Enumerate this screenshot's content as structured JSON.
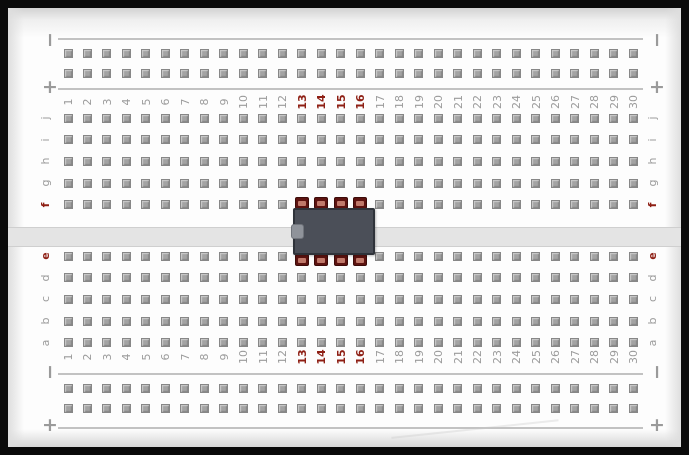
{
  "breadboard": {
    "column_count": 30,
    "column_numbers": [
      "1",
      "2",
      "3",
      "4",
      "5",
      "6",
      "7",
      "8",
      "9",
      "10",
      "11",
      "12",
      "13",
      "14",
      "15",
      "16",
      "17",
      "18",
      "19",
      "20",
      "21",
      "22",
      "23",
      "24",
      "25",
      "26",
      "27",
      "28",
      "29",
      "30"
    ],
    "red_columns": [
      "13",
      "14",
      "15",
      "16"
    ],
    "upper_row_letters": [
      "j",
      "i",
      "h",
      "g",
      "f"
    ],
    "lower_row_letters": [
      "e",
      "d",
      "c",
      "b",
      "a"
    ],
    "red_row_letters": [
      "f",
      "e"
    ],
    "power_rail": {
      "minus_symbol": "−",
      "plus_symbol": "+"
    },
    "colors": {
      "label_gray": "#9b9b9b",
      "label_red": "#8e1f14",
      "hole_fill": "#a3a3a3",
      "hole_border": "#878787",
      "rail_line": "#c2c2c2",
      "center_strip": "#e4e4e4",
      "board_background": "#fdfdfd",
      "frame": "#0a0a0a"
    }
  },
  "chip": {
    "name": "dip8-ic",
    "pins_per_side": 4,
    "start_column": 13,
    "end_column": 16,
    "upper_pin_row": "f",
    "lower_pin_row": "e",
    "body_color": "#4b4f58",
    "pin_dark_color": "#5d1310",
    "pin_light_color": "#c0796a",
    "notch_color": "#8f939a"
  }
}
